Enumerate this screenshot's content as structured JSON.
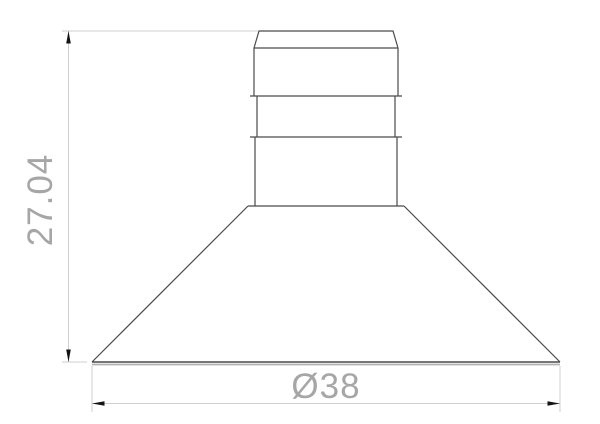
{
  "page": {
    "background": "#ffffff"
  },
  "colors": {
    "paper": "#ffffff",
    "outline": "#4a4a4a",
    "dimension_line": "#cfcfcf",
    "base_shadow": "#b3b3b3",
    "arrow": "#141414",
    "dimension_text": "#a6a6a6"
  },
  "drawing": {
    "kind": "technical-drawing",
    "part_shape": "suction cup: ribbed cylindrical stem with chamfered top over a conical skirt",
    "dimensions": [
      {
        "id": "height",
        "label": "27.04",
        "orientation": "vertical"
      },
      {
        "id": "diameter",
        "label": "Ø38",
        "orientation": "horizontal"
      }
    ]
  }
}
